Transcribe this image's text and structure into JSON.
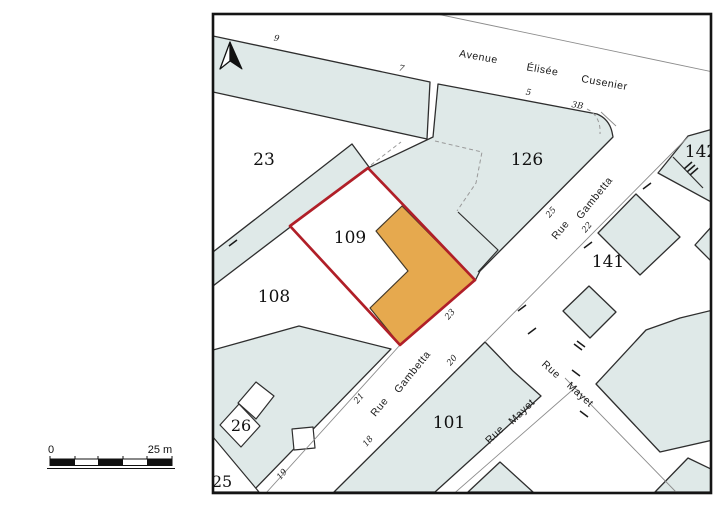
{
  "map_type": "cadastral-parcel-map",
  "colors": {
    "parcel_fill": "#dfe9e8",
    "parcel_stroke": "#2e2e2e",
    "highlight_fill": "#e6a94e",
    "highlight_outline": "#b01f28",
    "street_line": "#8c8c8c",
    "frame": "#141414"
  },
  "parcels": {
    "p23": "23",
    "p126": "126",
    "p142": "142",
    "p109": "109",
    "p108": "108",
    "p141": "141",
    "p101": "101",
    "p26": "26",
    "p25": "25"
  },
  "streets": {
    "avenue": [
      "Avenue",
      "Élisée",
      "Cusenier"
    ],
    "gambetta_upper": [
      "Rue",
      "Gambetta"
    ],
    "gambetta_lower": [
      "Rue",
      "Gambetta"
    ],
    "mayet_ne": [
      "Rue",
      "Mayet"
    ],
    "mayet_se": [
      "Rue",
      "Mayet"
    ]
  },
  "house_numbers": {
    "n9": "9",
    "n7": "7",
    "n5": "5",
    "n3b": "3B",
    "g25": "25",
    "g22": "22",
    "g23": "23",
    "g20": "20",
    "g21": "21",
    "g18": "18",
    "g19": "19"
  },
  "scale_bar": {
    "start": "0",
    "end": "25 m"
  },
  "icons": {
    "north_arrow": "north-arrow"
  },
  "highlighted_parcel": "109"
}
